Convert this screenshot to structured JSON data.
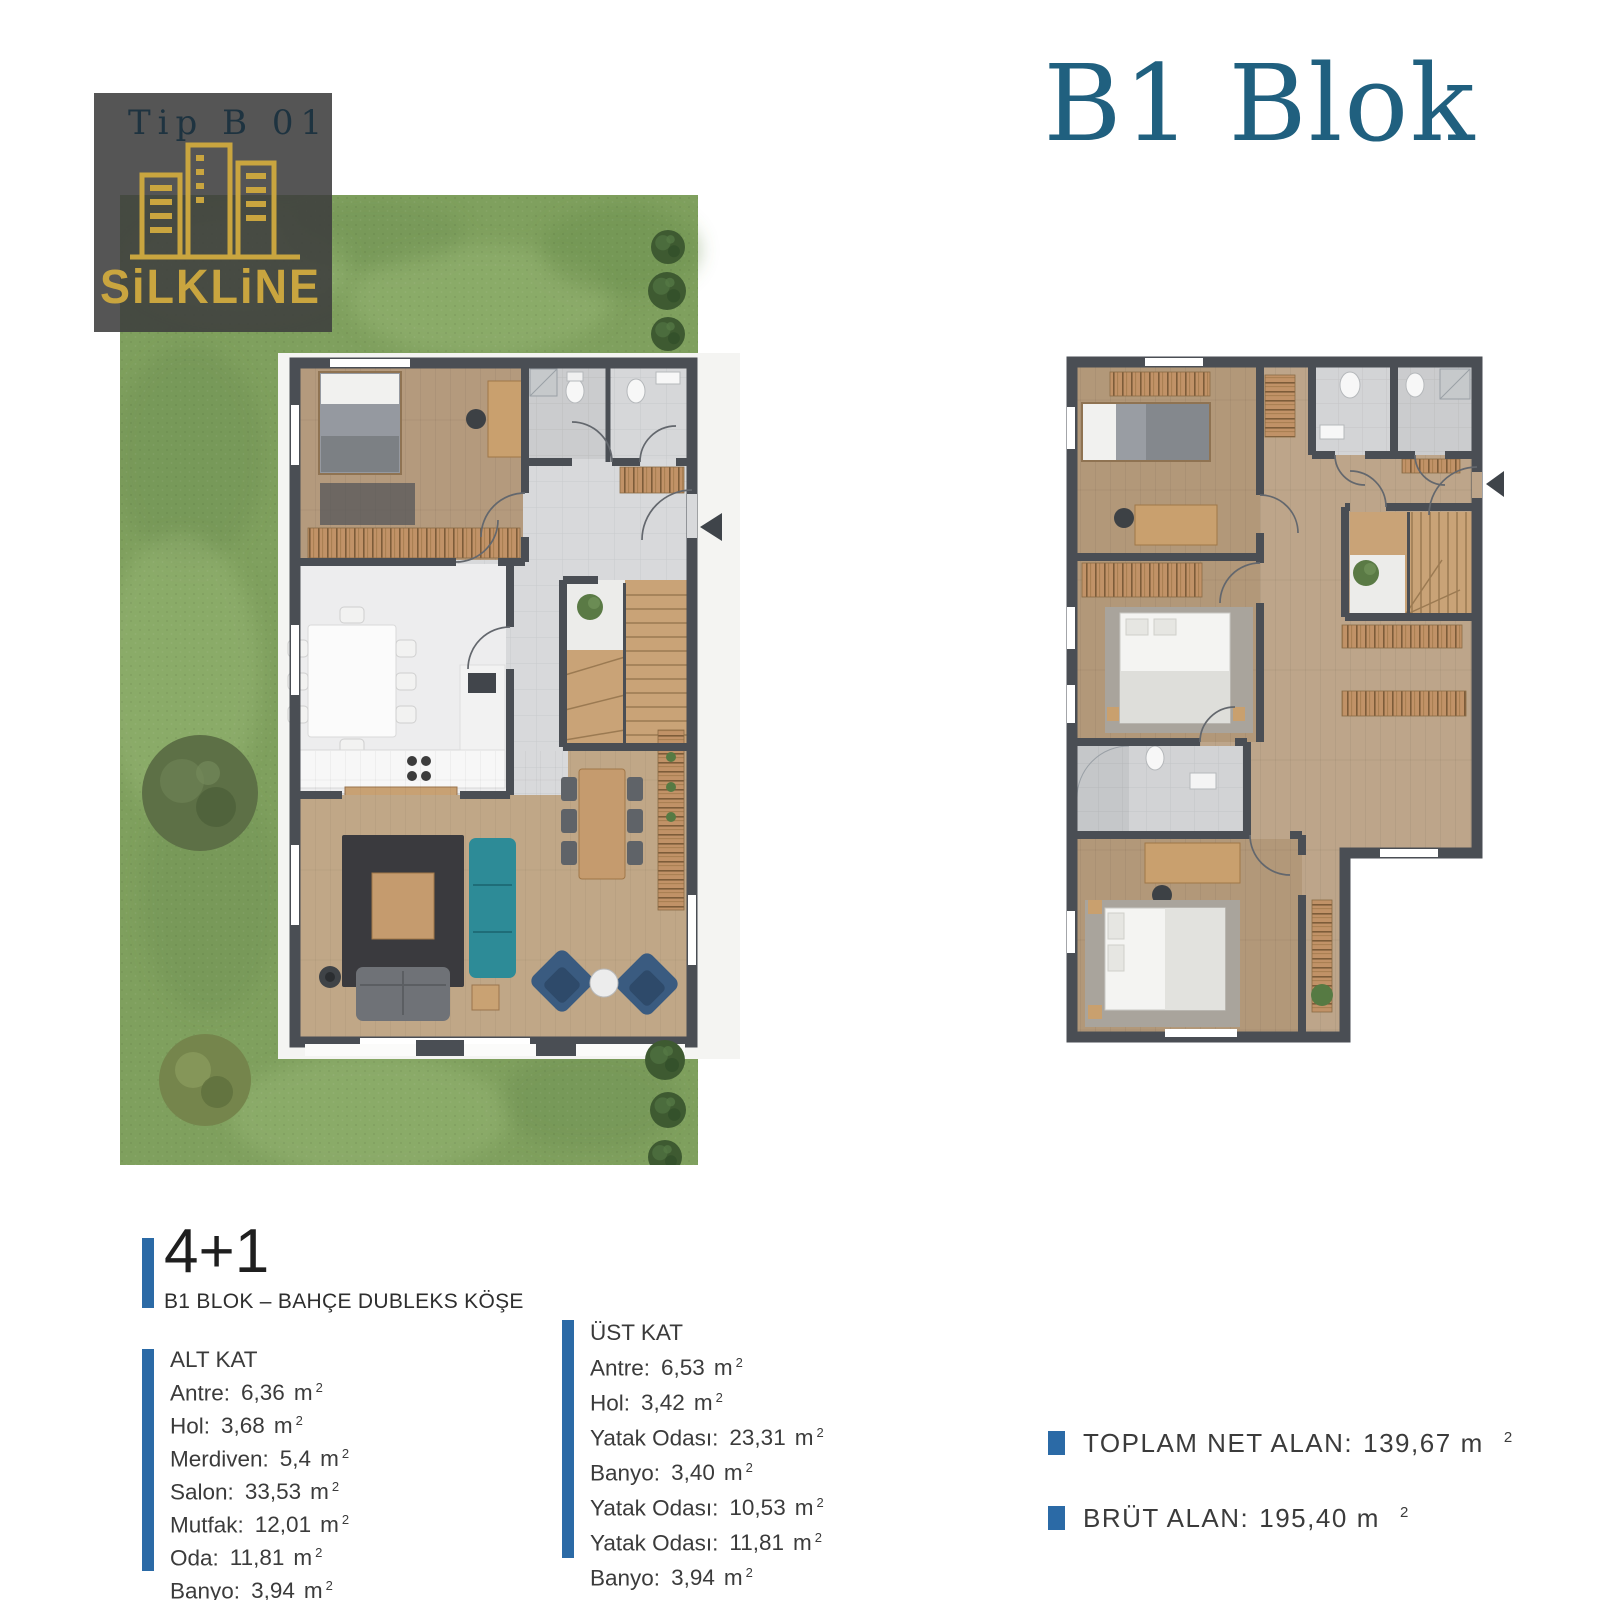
{
  "logo": {
    "type_label": "Tip B 01",
    "brand": "SiLKLiNE"
  },
  "header": {
    "title": "B1 Blok"
  },
  "unit": {
    "type": "4+1",
    "subtitle": "B1 BLOK – BAHÇE DUBLEKS KÖŞE"
  },
  "units": {
    "m": "m",
    "sup": "2"
  },
  "floors": [
    {
      "name": "ALT KAT",
      "items": [
        {
          "label": "Antre:",
          "value": "6,36"
        },
        {
          "label": "Hol:",
          "value": "3,68"
        },
        {
          "label": "Merdiven:",
          "value": "5,4"
        },
        {
          "label": "Salon:",
          "value": "33,53"
        },
        {
          "label": "Mutfak:",
          "value": "12,01"
        },
        {
          "label": "Oda:",
          "value": "11,81"
        },
        {
          "label": "Banyo:",
          "value": "3,94"
        }
      ]
    },
    {
      "name": "ÜST KAT",
      "items": [
        {
          "label": "Antre:",
          "value": "6,53"
        },
        {
          "label": "Hol:",
          "value": "3,42"
        },
        {
          "label": "Yatak Odası:",
          "value": "23,31"
        },
        {
          "label": "Banyo:",
          "value": "3,40"
        },
        {
          "label": "Yatak Odası:",
          "value": "10,53"
        },
        {
          "label": "Yatak Odası:",
          "value": "11,81"
        },
        {
          "label": "Banyo:",
          "value": "3,94"
        }
      ]
    }
  ],
  "totals": [
    {
      "label": "TOPLAM NET ALAN:",
      "value": "139,67"
    },
    {
      "label": "BRÜT ALAN:",
      "value": "195,40"
    }
  ],
  "icons": {
    "entrance_arrow": "left-pointing-triangle",
    "tree": "green-blob",
    "plant": "green-blob",
    "buildings": "three-gold-tower-outlines"
  },
  "colors": {
    "accent_blue": "#2b6aa6",
    "title_teal": "#20607f",
    "brand_gold": "#c9a53f",
    "logo_bg": "#3e3e3e",
    "logo_type_text": "#1e3340",
    "grass": "#7fa05e",
    "wall": "#4a4e54",
    "wood_floor": "#b79d80",
    "tile_floor": "#d8d9db",
    "teal_sofa": "#2d8b97",
    "blue_armchair": "#3a5b80",
    "body_text": "#3b3b3b"
  }
}
